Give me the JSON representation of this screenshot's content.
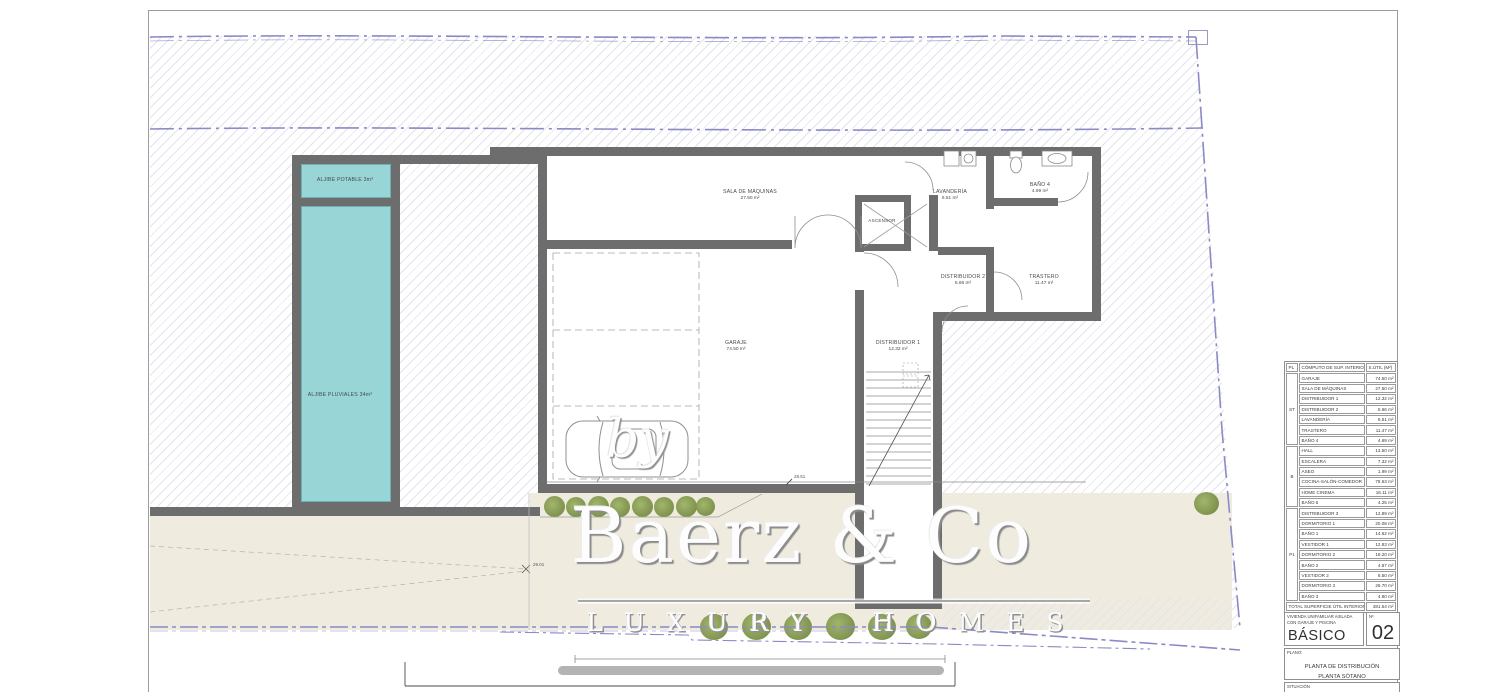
{
  "watermark": {
    "by": "by",
    "brand": "Baerz & Co",
    "tagline": "LUXURY HOMES"
  },
  "plan": {
    "tanks": {
      "potable": "ALJIBE POTABLE 3m³",
      "pluviales": "ALJIBE PLUVIALES 34m³"
    },
    "rooms": {
      "sala": {
        "name": "SALA DE MÁQUINAS",
        "area": "27.50 m²"
      },
      "ascensor": {
        "name": "ASCENSOR"
      },
      "lavanderia": {
        "name": "LAVANDERÍA",
        "area": "6.51 m²"
      },
      "bano4": {
        "name": "BAÑO 4",
        "area": "4.69 m²"
      },
      "distribuidor2": {
        "name": "DISTRIBUIDOR 2",
        "area": "5.66 m²"
      },
      "trastero": {
        "name": "TRASTERO",
        "area": "11.47 m²"
      },
      "garaje": {
        "name": "GARAJE",
        "area": "74.50 m²"
      },
      "distribuidor1": {
        "name": "DISTRIBUIDOR 1",
        "area": "12.32 m²"
      }
    },
    "dimensions": {
      "garage_line": "28.51",
      "site_point": "29.01"
    }
  },
  "table": {
    "headers": [
      "PL",
      "CÓMPUTO DE SUP. INTERIORES",
      "S.ÚTIL (M²)"
    ],
    "groups": [
      {
        "label": "ST",
        "rows": [
          [
            "GARAJE",
            "74.50 m²"
          ],
          [
            "SALA DE MÁQUINAS",
            "27.50 m²"
          ],
          [
            "DISTRIBUIDOR 1",
            "12.32 m²"
          ],
          [
            "DISTRIBUIDOR 2",
            "5.66 m²"
          ],
          [
            "LAVANDERÍA",
            "6.51 m²"
          ],
          [
            "TRASTERO",
            "11.47 m²"
          ],
          [
            "BAÑO 4",
            "4.69 m²"
          ]
        ]
      },
      {
        "label": "B",
        "rows": [
          [
            "HALL",
            "13.50 m²"
          ],
          [
            "ESCALERA",
            "7.32 m²"
          ],
          [
            "ASEO",
            "1.99 m²"
          ],
          [
            "COCINA-SALÓN-COMEDOR",
            "78.63 m²"
          ],
          [
            "HOME CINEMA",
            "16.11 m²"
          ],
          [
            "BAÑO 5",
            "4.25 m²"
          ]
        ]
      },
      {
        "label": "P1",
        "rows": [
          [
            "DISTRIBUIDOR 3",
            "12.89 m²"
          ],
          [
            "DORMITORIO 1",
            "20.08 m²"
          ],
          [
            "BAÑO 1",
            "14.62 m²"
          ],
          [
            "VESTIDOR 1",
            "12.83 m²"
          ],
          [
            "DORMITORIO 2",
            "18.20 m²"
          ],
          [
            "BAÑO 2",
            "4.87 m²"
          ],
          [
            "VESTIDOR 2",
            "6.50 m²"
          ],
          [
            "DORMITORIO 3",
            "26.70 m²"
          ],
          [
            "BAÑO 3",
            "4.80 m²"
          ]
        ]
      }
    ],
    "total": {
      "label": "TOTAL SUPERFICIE ÚTIL INTERIOR",
      "value": "381.54 m²"
    }
  },
  "titleblock": {
    "project_line1": "VIVIENDA UNIFAMILIAR AISLADA",
    "project_line2": "CON GARAJE Y PISCINA",
    "phase": "BÁSICO",
    "number_label": "Nº",
    "number": "02",
    "plano_label": "PLANO:",
    "plano_line1": "PLANTA DE DISTRIBUCIÓN",
    "plano_line2": "PLANTA SÓTANO",
    "situacion_label": "SITUACIÓN"
  }
}
